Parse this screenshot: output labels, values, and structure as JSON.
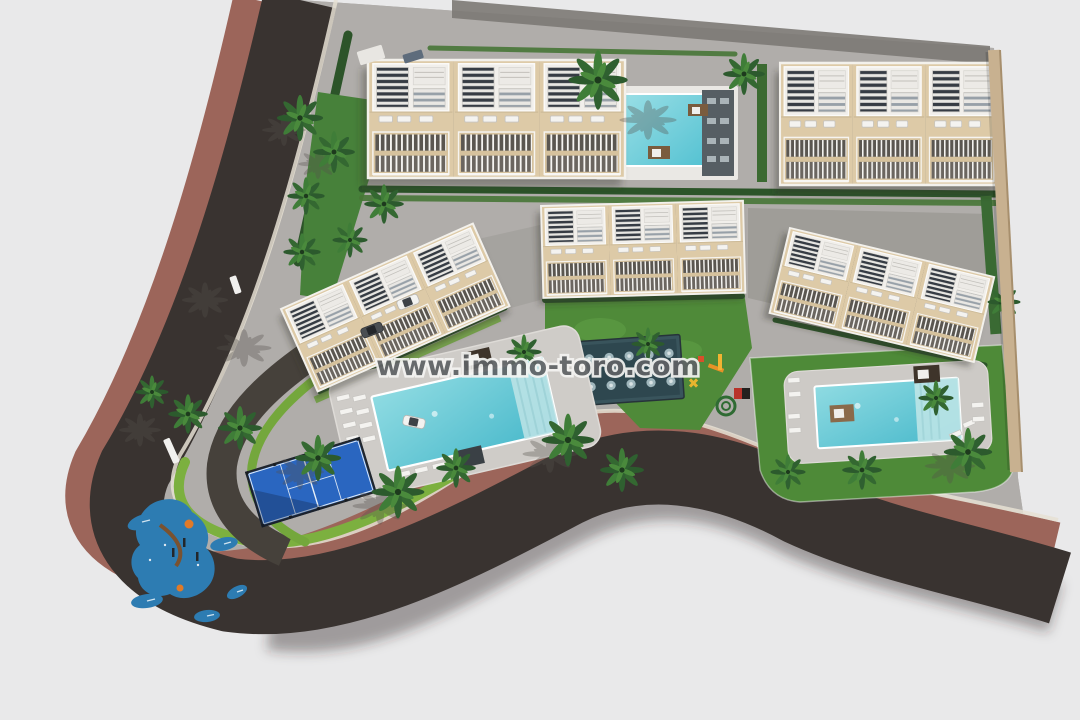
{
  "watermark": {
    "text": "www.immo-toro.com"
  },
  "palette": {
    "background": "#e9e9ea",
    "asphalt_road": "#393330",
    "sidewalk_brown": "#9c655a",
    "paving_gray": "#b0adaa",
    "paving_dark": "#7c7974",
    "curb_white": "#e6e0d4",
    "grass_green": "#4f8a39",
    "bright_grass": "#7cb03f",
    "hedge_green": "#2c5429",
    "pool_water": "#8fdbe2",
    "pool_deep": "#49b9cb",
    "building_beige": "#ddcaa7",
    "roof_white": "#f1efeb",
    "solar_slat": "#363c44",
    "padel_court_blue": "#2a66c0",
    "playground_pad_blue": "#2d7cb2",
    "boundary_wall_tan": "#c8b190",
    "cabana_brown": "#3e342a"
  },
  "scene_features": [
    "aerial site plan rendering",
    "five apartment blocks",
    "three swimming pools",
    "padel court",
    "children playground",
    "perimeter road with brown sidewalk",
    "palm trees and lawns"
  ]
}
